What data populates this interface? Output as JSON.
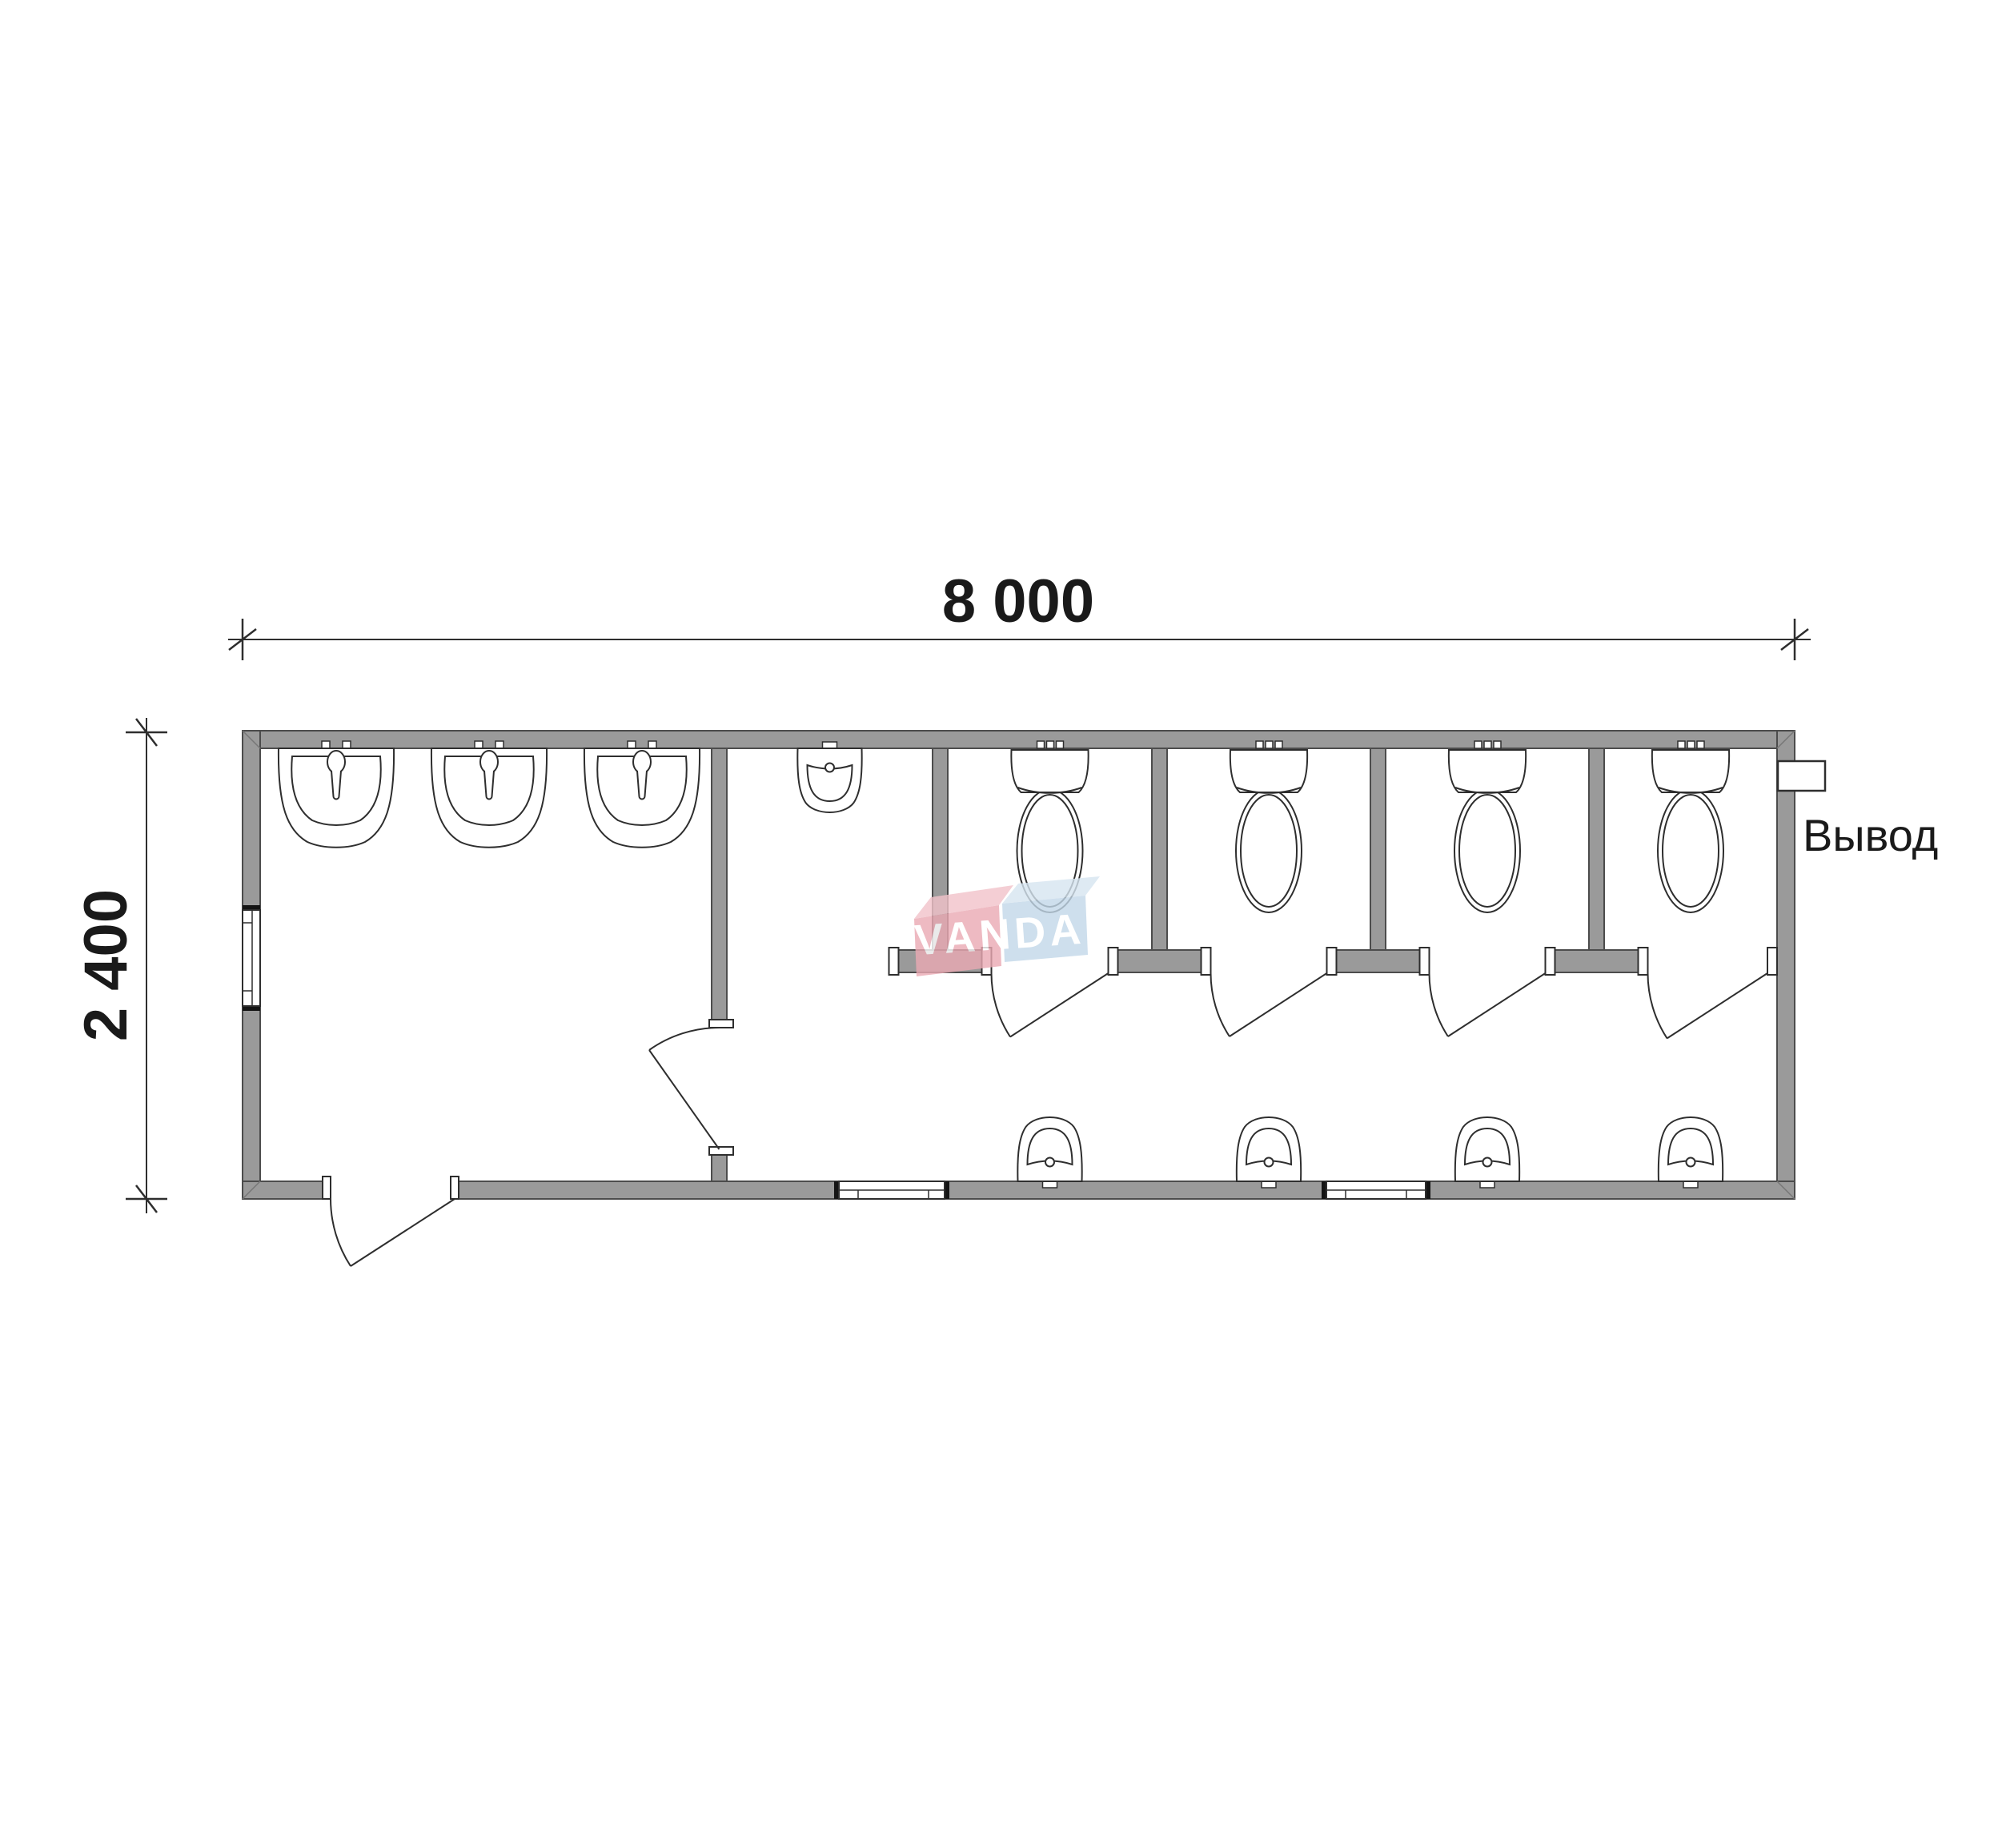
{
  "document": {
    "type": "architectural floor plan of sanitary container (toilet block)",
    "background": "#ffffff"
  },
  "dimensions": {
    "width": {
      "label": "8 000"
    },
    "height": {
      "label": "2 400"
    }
  },
  "labels": {
    "outlet": "Вывод"
  },
  "watermark": {
    "text": "VANDA",
    "red_box": "#eba9b3",
    "red_box_top": "#f2c3ca",
    "blue_box": "#c3d8e9",
    "blue_box_top": "#d7e6f1",
    "text_color": "#ffffff"
  },
  "palette": {
    "wall_fill": "#9a9a9a",
    "wall_edge": "#4c4c4c",
    "line": "#2e2e2e",
    "cap": "#141414",
    "dim_line": "#2e2e2e"
  },
  "fixtures": {
    "washbasins": 3,
    "toilets": 4,
    "urinals": 5,
    "windows": 3,
    "doors": 6,
    "toilet_stalls": 4
  }
}
